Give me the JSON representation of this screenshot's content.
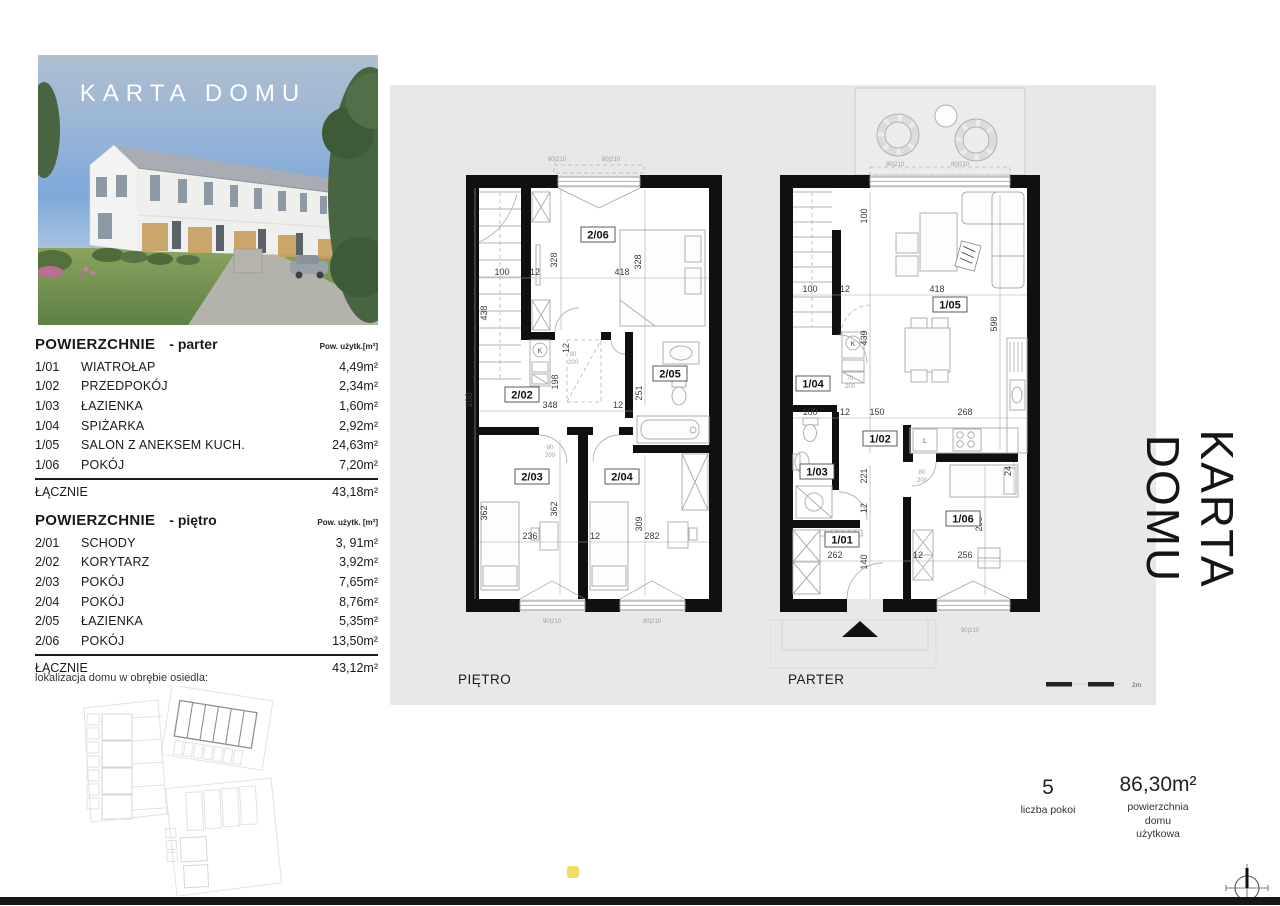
{
  "page": {
    "colors": {
      "panel": "#e8e8e8",
      "accent_dot": "#f2dd66",
      "wall": "#111111"
    }
  },
  "header": {
    "title": "KARTA DOMU"
  },
  "side_title": "KARTA DOMU",
  "sidebar": {
    "location_caption": "lokalizacja domu w obrębie osiedla:",
    "tables": [
      {
        "title": "POWIERZCHNIE",
        "subtitle": "- parter",
        "unit": "Pow. użytk.[m²]",
        "rows": [
          {
            "id": "1/01",
            "name": "WIATROŁAP",
            "area": "4,49m²"
          },
          {
            "id": "1/02",
            "name": "PRZEDPOKÓJ",
            "area": "2,34m²"
          },
          {
            "id": "1/03",
            "name": "ŁAZIENKA",
            "area": "1,60m²"
          },
          {
            "id": "1/04",
            "name": "SPIŻARKA",
            "area": "2,92m²"
          },
          {
            "id": "1/05",
            "name": "SALON Z ANEKSEM KUCH.",
            "area": "24,63m²"
          },
          {
            "id": "1/06",
            "name": "POKÓJ",
            "area": "7,20m²"
          }
        ],
        "total_label": "ŁĄCZNIE",
        "total": "43,18m²"
      },
      {
        "title": "POWIERZCHNIE",
        "subtitle": "- piętro",
        "unit": "Pow. użytk. [m²]",
        "rows": [
          {
            "id": "2/01",
            "name": "SCHODY",
            "area": "3, 91m²"
          },
          {
            "id": "2/02",
            "name": "KORYTARZ",
            "area": "3,92m²"
          },
          {
            "id": "2/03",
            "name": "POKÓJ",
            "area": "7,65m²"
          },
          {
            "id": "2/04",
            "name": "POKÓJ",
            "area": "8,76m²"
          },
          {
            "id": "2/05",
            "name": "ŁAZIENKA",
            "area": "5,35m²"
          },
          {
            "id": "2/06",
            "name": "POKÓJ",
            "area": "13,50m²"
          }
        ],
        "total_label": "ŁĄCZNIE",
        "total": "43,12m²"
      }
    ]
  },
  "plans": {
    "scale_label": "2m",
    "pietro": {
      "label": "PIĘTRO",
      "washer_letter": "K",
      "rooms": [
        "2/06",
        "2/02",
        "2/05",
        "2/03",
        "2/04"
      ],
      "dims": [
        "100",
        "12",
        "418",
        "328",
        "328",
        "438",
        "198",
        "12",
        "348",
        "12",
        "100",
        "251",
        "362",
        "362",
        "309",
        "236",
        "12",
        "282"
      ],
      "marks": [
        "80|210",
        "80|210",
        "90|210",
        "90|210",
        "80",
        "200",
        "80",
        "200"
      ]
    },
    "parter": {
      "label": "PARTER",
      "washer_letter": "K",
      "fridge_letter": "L",
      "rooms": [
        "1/05",
        "1/04",
        "1/02",
        "1/03",
        "1/01",
        "1/06"
      ],
      "dims": [
        "100",
        "12",
        "418",
        "100",
        "439",
        "598",
        "100",
        "12",
        "150",
        "268",
        "221",
        "12",
        "24",
        "290",
        "262",
        "140",
        "12",
        "256"
      ],
      "marks": [
        "80|210",
        "80|210",
        "70",
        "200",
        "80",
        "200",
        "90|210"
      ]
    }
  },
  "summary": {
    "rooms_value": "5",
    "rooms_label": "liczba pokoi",
    "area_value": "86,30m²",
    "area_label": "powierzchnia\ndomu\nużytkowa"
  }
}
